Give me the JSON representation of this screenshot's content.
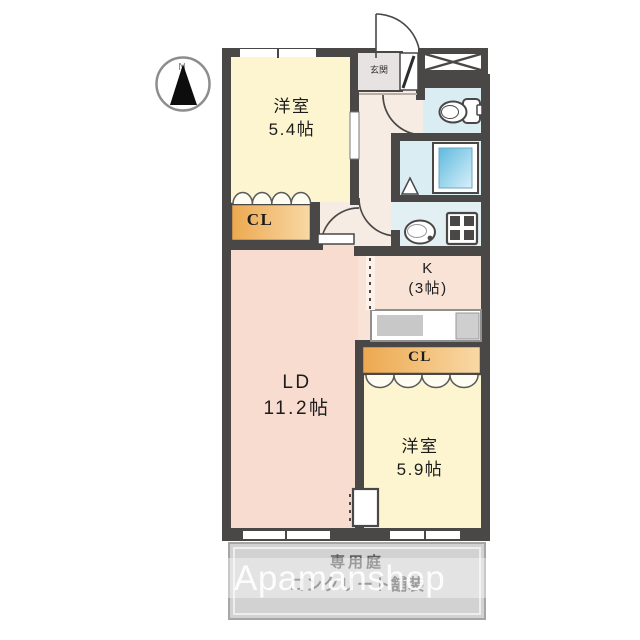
{
  "title": "間取り図 (floor plan)",
  "compass": {
    "label": "N"
  },
  "rooms": {
    "bedroom1": {
      "name": "洋室",
      "size": "5.4帖"
    },
    "entrance": {
      "label": "玄関"
    },
    "closet1": {
      "label": "CL"
    },
    "kitchen": {
      "name": "K",
      "size": "(3帖)"
    },
    "living_dining": {
      "name": "LD",
      "size": "11.2帖"
    },
    "closet2": {
      "label": "CL"
    },
    "bedroom2": {
      "name": "洋室",
      "size": "5.9帖"
    }
  },
  "garden": {
    "line1": "専用庭",
    "line2": "コンクリート舗装"
  },
  "watermark": {
    "text": "Apamanshop"
  },
  "icons": {
    "compass": "north-compass-icon",
    "toilet": "toilet-icon",
    "bathtub": "bathtub-icon",
    "washbasin": "washbasin-icon",
    "washer_pan": "washing-machine-pan-icon",
    "stove": "stove-icon",
    "meter_box": "meter-box-x-icon"
  },
  "colors": {
    "wall": "#4a4747",
    "room_cream": "#fcf5d0",
    "room_pink": "#f8dccf",
    "hall_pink": "#f7ece3",
    "closet_orange_dark": "#eda84f",
    "closet_orange_light": "#f8d9a6",
    "water_blue": "#d9edf2",
    "tub_blue": "#5fbade",
    "garden_gray": "#d2d2d2"
  }
}
